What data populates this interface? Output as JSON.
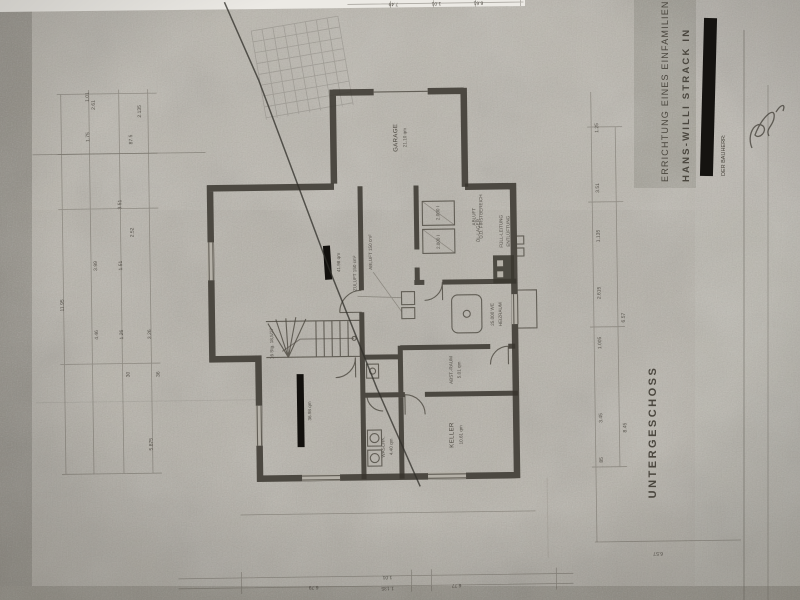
{
  "floor_label": "UNTERGESCHOSS",
  "title_block": {
    "project": "ERRICHTUNG EINES EINFAMILIEN",
    "client": "HANS-WILLI  STRACK  IN",
    "bauherr_label": "DER BAUHERR:"
  },
  "rooms": {
    "garage": {
      "name": "GARAGE",
      "area": "21.10 qm"
    },
    "oel_lager": {
      "name": "ÖL-LAGER"
    },
    "heizraum": {
      "name": "HEIZRAUM",
      "detail": "25.000 WE"
    },
    "abstellraum": {
      "name": "ABST.-RAUM",
      "area": "5.01 qm"
    },
    "keller": {
      "name": "KELLER",
      "area": "10.61 qm"
    },
    "waschkueche": {
      "name": "WASCHK.",
      "area": "4.40 qm"
    },
    "redacted_room_upper": {
      "area": "41.98 qm"
    },
    "redacted_room_lower": {
      "area": "36.98 qm"
    }
  },
  "annotations": {
    "tank_1": "2.000 l",
    "tank_2": "2.000 l",
    "fuell_leitung": "FÜLL-LEITUNG",
    "entlueftung": "ENTLÜFTUNG",
    "abluft_dach_1": "ABLUFT",
    "abluft_dach_2": "Ü.D. FIRSTBEREICH",
    "zuluft": "ZULUFT 150 cm²",
    "abluft": "ABLUFT 150 cm²",
    "stair": "16 Stg. 18,5/27"
  },
  "dimensions": {
    "left": [
      "2.61",
      "1.75",
      "3.51",
      "87.5",
      "30",
      "36",
      "2.52",
      "2.135",
      "5.875",
      "3.99",
      "1.51",
      "1.26",
      "3.26",
      "4.46",
      "11.95",
      "1.01"
    ],
    "right": [
      "1.25",
      "3.51",
      "1.135",
      "2.615",
      "6.57",
      "1.005",
      "3.45",
      "85",
      "8.45"
    ],
    "bottom": [
      "6.79",
      "1.01",
      "1.135",
      "6.77",
      "6.57"
    ],
    "top": [
      "7.49",
      "1.01",
      "6.61"
    ]
  }
}
